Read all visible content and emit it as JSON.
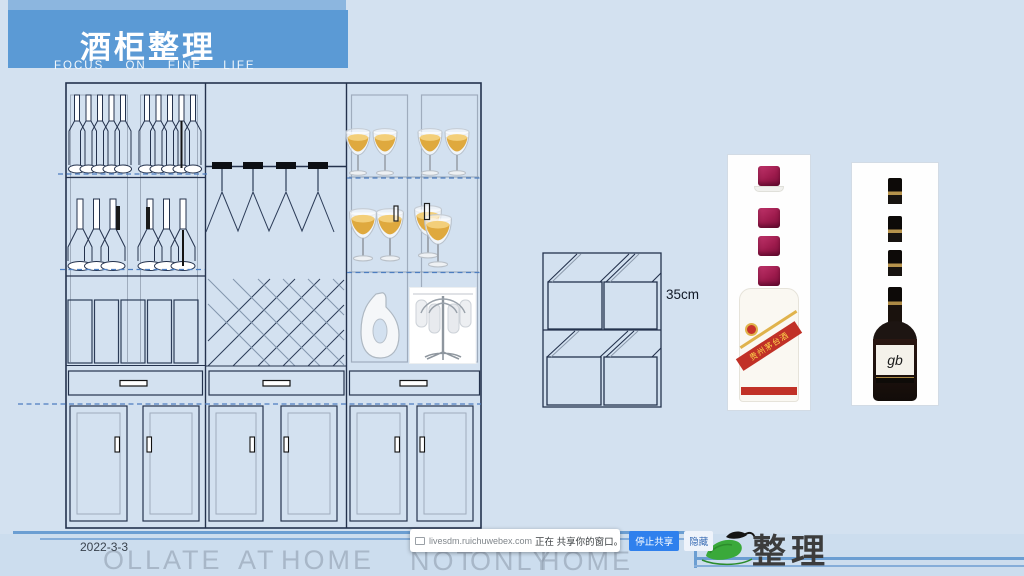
{
  "header": {
    "title": "酒柜整理",
    "subtitle": "FOCUS ON FINE LIFE"
  },
  "diagram": {
    "dimension_label": "35cm"
  },
  "products": {
    "moutai_label": "贵州茅台酒",
    "wine_label": "gb"
  },
  "footer": {
    "date": "2022-3-3",
    "watermark": {
      "w1": "OLLATE",
      "w2": "AT",
      "w3": "HOME",
      "w4": "NOT",
      "w5": "ONLY",
      "w6": "HOME"
    },
    "logo_text": "整理"
  },
  "share_bar": {
    "source": "livesdm.ruichuwebex.com",
    "message": "正在 共享你的窗口。",
    "stop_label": "停止共享",
    "hide_label": "隐藏"
  },
  "colors": {
    "accent_blue": "#5b9ad5",
    "cap_red": "#9e1b4d",
    "button_blue": "#2f80ed",
    "line_blue": "#6b9ed2"
  }
}
